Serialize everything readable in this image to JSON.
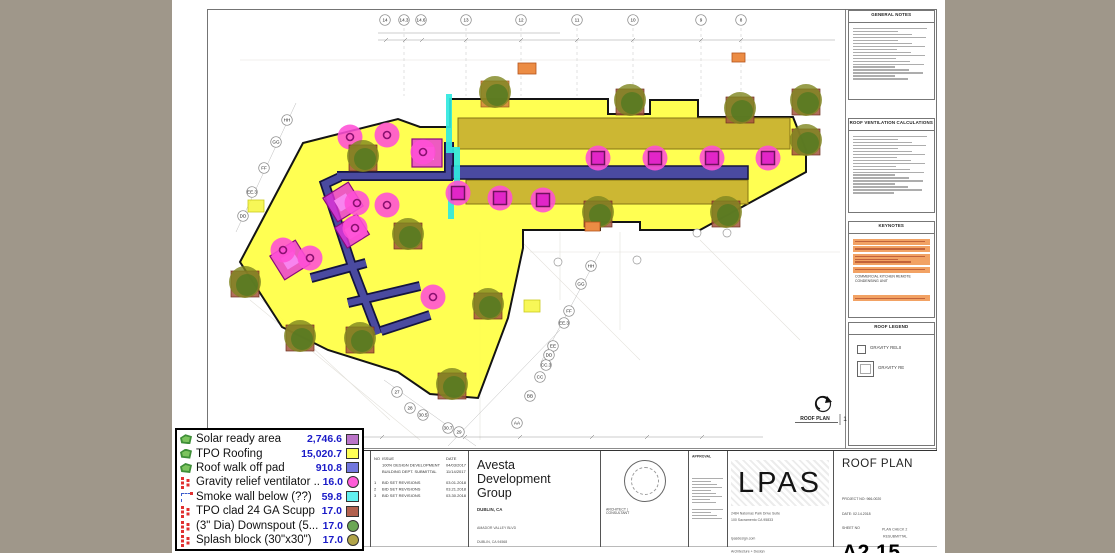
{
  "legend": {
    "items": [
      {
        "label": "Solar ready area",
        "value": "2,746.6",
        "swatch": "#bb74c8"
      },
      {
        "label": "TPO Roofing",
        "value": "15,020.7",
        "swatch": "#ffff55"
      },
      {
        "label": "Roof walk off pad",
        "value": "910.8",
        "swatch": "#7277de"
      },
      {
        "label": "Gravity relief ventilator ...",
        "value": "16.0",
        "swatch": "#ff5cd8"
      },
      {
        "label": "Smoke wall below (??)",
        "value": "59.8",
        "swatch": "#62f0f0"
      },
      {
        "label": "TPO clad 24 GA Scupp",
        "value": "17.0",
        "swatch": "#b2614e"
      },
      {
        "label": "(3\" Dia) Downspout (5...",
        "value": "17.0",
        "swatch": "#6ba754"
      },
      {
        "label": "Splash block (30\"x30\")",
        "value": "17.0",
        "swatch": "#b1a449"
      }
    ]
  },
  "titleblock": {
    "issue": {
      "headers": {
        "no": "NO",
        "issue": "ISSUE",
        "date": "DATE"
      },
      "rows": [
        {
          "no": "",
          "issue": "100% DESIGN DEVELOPMENT",
          "date": "04/03/2017"
        },
        {
          "no": "",
          "issue": "BUILDING DEPT. SUBMITTAL",
          "date": "11/14/2017"
        },
        {
          "no": "1",
          "issue": "BID SET REVISIONS",
          "date": "03.01.2018"
        },
        {
          "no": "2",
          "issue": "BID SET REVISIONS",
          "date": "03.21.2018"
        },
        {
          "no": "3",
          "issue": "BID SET REVISIONS",
          "date": "03.30.2018"
        }
      ]
    },
    "client": {
      "name": "Avesta Development Group",
      "city": "DUBLIN, CA",
      "address1": "AMADOR VALLEY BLVD",
      "address2": "DUBLIN, CA 94568"
    },
    "stamp_caption": "ARCHITECT | CONSULTANT",
    "approval_label": "APPROVAL",
    "firm": {
      "logo": "LPAS",
      "address": "2484 Natomas Park Drive Suite 100  Sacramento CA 95833",
      "contact": "lpasdesign.com",
      "tagline": "Architecture + Design"
    },
    "sheet": {
      "title": "ROOF PLAN",
      "project_no": "PROJECT NO:  966-0020",
      "date": "DATE:  02.14.2018",
      "sheet_no_label": "SHEET NO",
      "number": "A2.15",
      "note1": "PLAN CHECK 2",
      "note2": "RESUBMITTAL"
    }
  },
  "panels": {
    "general_notes": {
      "title": "GENERAL NOTES"
    },
    "vent_calc": {
      "title": "ROOF VENTILATION CALCULATIONS"
    },
    "keynotes": {
      "title": "KEYNOTES",
      "readable_row": "COMMERCIAL KITCHEN REMOTE CONDENSING UNIT"
    },
    "roof_legend": {
      "title": "ROOF LEGEND",
      "item1": "GRAVITY RELIEF VENTILATOR",
      "item2": "GRAVITY RELIEF VENTILATOR"
    }
  },
  "drawing": {
    "plan_label": "ROOF PLAN",
    "plan_number": "1",
    "grid_top": [
      "14",
      "14.3",
      "14.6",
      "13",
      "12",
      "11",
      "10",
      "9",
      "8"
    ],
    "grid_left": [
      "HH",
      "GG",
      "FF",
      "EE.3",
      "DD"
    ],
    "grid_diag": [
      "HH",
      "GG",
      "FF",
      "EE.3",
      "EE"
    ],
    "grid_bottom": [
      "27",
      "28",
      "30.5",
      "30.7",
      "29",
      "AA",
      "BB",
      "CC",
      "CC.3",
      "DD"
    ]
  }
}
